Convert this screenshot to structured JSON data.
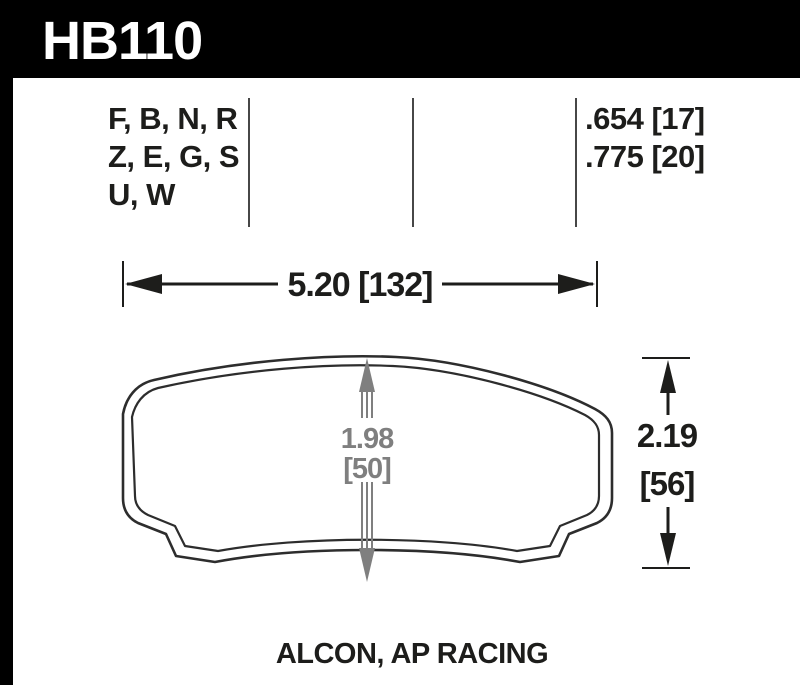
{
  "header": {
    "part_number": "HB110"
  },
  "spec_row": {
    "compound_lines": [
      "F, B, N, R",
      "Z, E, G, S",
      "U, W"
    ],
    "thickness_values": [
      ".654 [17]",
      ".775 [20]"
    ]
  },
  "dimensions": {
    "width_label": "5.20 [132]",
    "height_value": "2.19",
    "height_mm": "[56]",
    "center_value": "1.98",
    "center_mm": "[50]"
  },
  "footer": {
    "application": "ALCON, AP RACING"
  },
  "colors": {
    "header_bg": "#000000",
    "header_text": "#ffffff",
    "body_bg": "#ffffff",
    "text": "#1d1d1b",
    "outline": "#2d2d2d",
    "dim_gray": "#7f7f7f",
    "divider": "#474747"
  }
}
